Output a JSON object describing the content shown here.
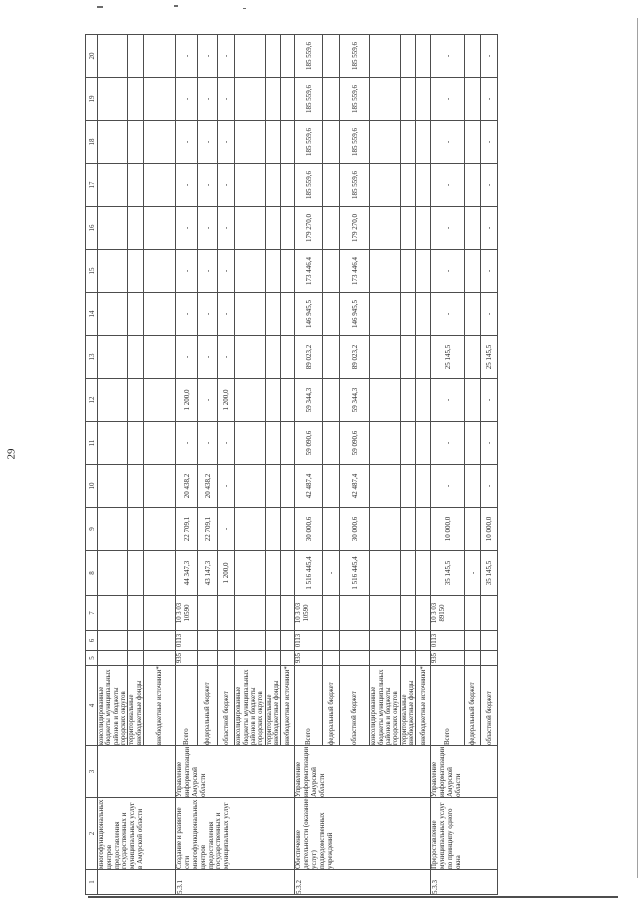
{
  "page_number": "29",
  "table": {
    "column_numbers": [
      "1",
      "2",
      "3",
      "4",
      "5",
      "6",
      "7",
      "8",
      "9",
      "10",
      "11",
      "12",
      "13",
      "14",
      "15",
      "16",
      "17",
      "18",
      "19",
      "20"
    ],
    "groups": [
      {
        "num": "",
        "name": "многофункциональных центров предоставления государственных и муниципальных услуг в Амурской области",
        "executor": "",
        "rows": [
          {
            "source": "консолидированные бюджеты муниципальных районов и бюджеты городских округов",
            "grbs": "",
            "rzpr": "",
            "csr": "",
            "values": [
              "",
              "",
              "",
              "",
              "",
              "",
              "",
              "",
              "",
              "",
              "",
              "",
              ""
            ]
          },
          {
            "source": "территориальные внебюджетные фонды",
            "grbs": "",
            "rzpr": "",
            "csr": "",
            "values": [
              "",
              "",
              "",
              "",
              "",
              "",
              "",
              "",
              "",
              "",
              "",
              "",
              ""
            ]
          },
          {
            "source": "внебюджетные источники*",
            "grbs": "",
            "rzpr": "",
            "csr": "",
            "values": [
              "",
              "",
              "",
              "",
              "",
              "",
              "",
              "",
              "",
              "",
              "",
              "",
              ""
            ]
          }
        ]
      },
      {
        "num": "5.3.1",
        "name": "Создание и развитие сети многофункциональных центров предоставления государственных и муниципальных услуг",
        "executor": "Управление информатизации Амурской области",
        "rows": [
          {
            "source": "Всего",
            "grbs": "935",
            "rzpr": "0113",
            "csr": "10 3 03 10590",
            "values": [
              "44 347,3",
              "22 709,1",
              "20 438,2",
              "-",
              "1 200,0",
              "-",
              "-",
              "-",
              "-",
              "-",
              "-",
              "-",
              "-"
            ]
          },
          {
            "source": "федеральный бюджет",
            "grbs": "",
            "rzpr": "",
            "csr": "",
            "values": [
              "43 147,3",
              "22 709,1",
              "20 438,2",
              "-",
              "-",
              "-",
              "-",
              "-",
              "-",
              "-",
              "-",
              "-",
              "-"
            ]
          },
          {
            "source": "областной бюджет",
            "grbs": "",
            "rzpr": "",
            "csr": "",
            "values": [
              "1 200,0",
              "-",
              "-",
              "-",
              "1 200,0",
              "-",
              "-",
              "-",
              "-",
              "-",
              "-",
              "-",
              "-"
            ]
          },
          {
            "source": "консолидированные бюджеты муниципальных районов и бюджеты городских округов",
            "grbs": "",
            "rzpr": "",
            "csr": "",
            "values": [
              "",
              "",
              "",
              "",
              "",
              "",
              "",
              "",
              "",
              "",
              "",
              "",
              ""
            ]
          },
          {
            "source": "территориальные внебюджетные фонды",
            "grbs": "",
            "rzpr": "",
            "csr": "",
            "values": [
              "",
              "",
              "",
              "",
              "",
              "",
              "",
              "",
              "",
              "",
              "",
              "",
              ""
            ]
          },
          {
            "source": "внебюджетные источники*",
            "grbs": "",
            "rzpr": "",
            "csr": "",
            "values": [
              "",
              "",
              "",
              "",
              "",
              "",
              "",
              "",
              "",
              "",
              "",
              "",
              ""
            ]
          }
        ]
      },
      {
        "num": "5.3.2",
        "name": "Обеспечение деятельности (оказание услуг) подведомственных учреждений",
        "executor": "Управление информатизации Амурской области",
        "rows": [
          {
            "source": "Всего",
            "grbs": "935",
            "rzpr": "0113",
            "csr": "10 3 03 10590",
            "values": [
              "1 516 445,4",
              "30 000,6",
              "42 487,4",
              "59 090,6",
              "59 344,3",
              "89 023,2",
              "146 945,5",
              "173 446,4",
              "179 270,0",
              "185 559,6",
              "185 559,6",
              "185 559,6",
              "185 559,6"
            ]
          },
          {
            "source": "федеральный бюджет",
            "grbs": "",
            "rzpr": "",
            "csr": "",
            "values": [
              "-",
              "",
              "",
              "",
              "",
              "",
              "",
              "",
              "",
              "",
              "",
              "",
              ""
            ]
          },
          {
            "source": "областной бюджет",
            "grbs": "",
            "rzpr": "",
            "csr": "",
            "values": [
              "1 516 445,4",
              "30 000,6",
              "42 487,4",
              "59 090,6",
              "59 344,3",
              "89 023,2",
              "146 945,5",
              "173 446,4",
              "179 270,0",
              "185 559,6",
              "185 559,6",
              "185 559,6",
              "185 559,6"
            ]
          },
          {
            "source": "консолидированные бюджеты муниципальных районов и бюджеты городских округов",
            "grbs": "",
            "rzpr": "",
            "csr": "",
            "values": [
              "",
              "",
              "",
              "",
              "",
              "",
              "",
              "",
              "",
              "",
              "",
              "",
              ""
            ]
          },
          {
            "source": "территориальные внебюджетные фонды",
            "grbs": "",
            "rzpr": "",
            "csr": "",
            "values": [
              "",
              "",
              "",
              "",
              "",
              "",
              "",
              "",
              "",
              "",
              "",
              "",
              ""
            ]
          },
          {
            "source": "внебюджетные источники*",
            "grbs": "",
            "rzpr": "",
            "csr": "",
            "values": [
              "",
              "",
              "",
              "",
              "",
              "",
              "",
              "",
              "",
              "",
              "",
              "",
              ""
            ]
          }
        ]
      },
      {
        "num": "5.3.3",
        "name": "Предоставление муниципальных услуг по принципу одного окна",
        "executor": "Управление информатизации Амурской области",
        "rows": [
          {
            "source": "Всего",
            "grbs": "935",
            "rzpr": "0113",
            "csr": "10 3 03 89150",
            "values": [
              "35 145,5",
              "10 000,0",
              "-",
              "-",
              "-",
              "25 145,5",
              "-",
              "-",
              "-",
              "-",
              "-",
              "-",
              "-"
            ]
          },
          {
            "source": "федеральный бюджет",
            "grbs": "",
            "rzpr": "",
            "csr": "",
            "values": [
              "-",
              "",
              "",
              "",
              "",
              "",
              "",
              "",
              "",
              "",
              "",
              "",
              ""
            ]
          },
          {
            "source": "областной бюджет",
            "grbs": "",
            "rzpr": "",
            "csr": "",
            "values": [
              "35 145,5",
              "10 000,0",
              "-",
              "-",
              "-",
              "25 145,5",
              "-",
              "-",
              "-",
              "-",
              "-",
              "-",
              "-"
            ]
          }
        ]
      }
    ]
  }
}
